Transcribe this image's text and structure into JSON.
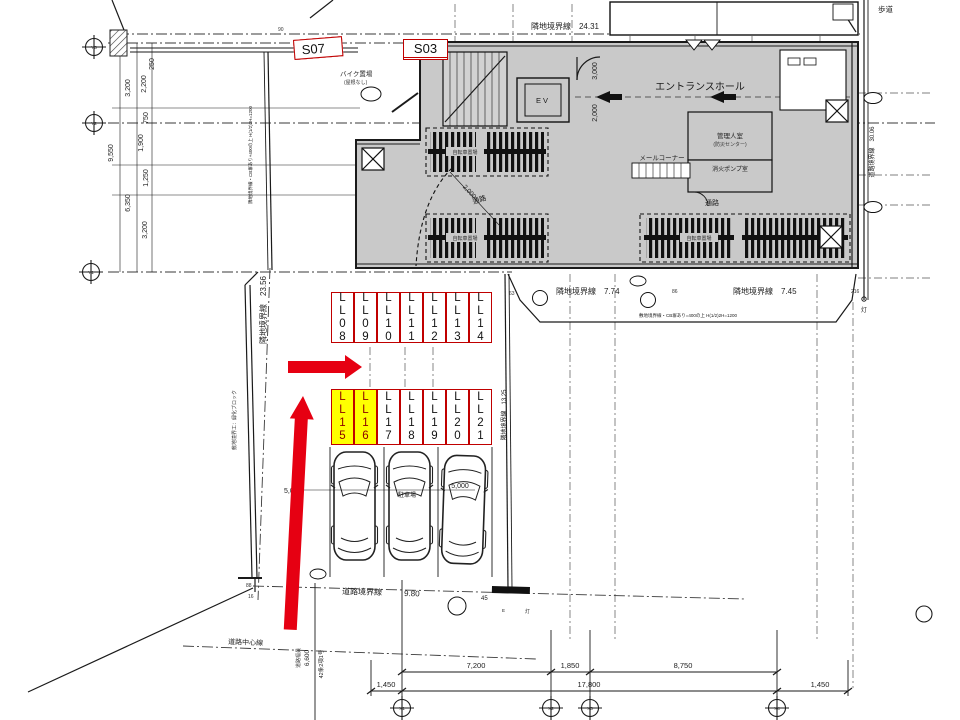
{
  "annotations": {
    "left_labels": [
      "LL04",
      "LL05",
      "LL06",
      "S07"
    ],
    "stair_labels": [
      "S01",
      "S02",
      "S03"
    ],
    "row1_labels": [
      "LL08",
      "LL09",
      "LL10",
      "LL11",
      "LL12",
      "LL13",
      "LL14"
    ],
    "row2_labels": [
      "LL15",
      "LL16",
      "LL17",
      "LL18",
      "LL19",
      "LL20",
      "LL21"
    ],
    "highlighted_labels": [
      "LL15",
      "LL16"
    ],
    "highlight_color": "#ffff00",
    "highlight_text_color": "#8b0000",
    "box_border_color": "#c00000",
    "arrow_color": "#e60012"
  },
  "plan": {
    "boundaries": {
      "top": "隣地境界線　24.31",
      "left": "隣地境界線　23.56",
      "left_note": "隣地境界線・CB塀あり+400の上 H(1/2)3H=1200",
      "left_fence": "敷地境界工：緑化ブロック",
      "bottom_mid1": "隣地境界線　7.74",
      "bottom_mid2": "隣地境界線　7.45",
      "bottom_note": "敷地境界線・CB塀あり=400の上 H(1/2)2H=1200",
      "inner_right": "隣地境界線　13.25",
      "road": "道路境界線",
      "road_val": "9.80",
      "road_right": "道路境界線　30.06",
      "road_center": "道路中心線",
      "road_width_label": "道路幅員",
      "road_width_val": "6,600",
      "road_class": "42条2項1号",
      "sidewalk": "歩道"
    },
    "rooms": {
      "entrance": "エントランスホール",
      "ev": "EV",
      "mail": "メールコーナー",
      "manager": "管理人室",
      "manager2": "(防災センター)",
      "pump": "消火ポンプ室",
      "corridor": "通路",
      "bike_racks": "自転車置場",
      "moto": "バイク置場",
      "moto2": "(屋根なし)",
      "parking": "駐車場"
    },
    "dims": {
      "left": [
        "250",
        "3,200",
        "2,200",
        "750",
        "1,900",
        "9,550",
        "1,250",
        "6,350",
        "3,200"
      ],
      "bottom_upper": [
        "7,200",
        "1,850",
        "8,750"
      ],
      "bottom_lower": [
        "1,450",
        "17,800",
        "1,450"
      ],
      "v3000": "3,000",
      "v2000": "2,000",
      "diag2000": "2,000",
      "p5000": "5,000",
      "misc": {
        "d90": "90",
        "d45": "45",
        "d86": "86",
        "d63": "63",
        "d88": "88",
        "d16": "16",
        "d216": "216",
        "lamp": "灯",
        "e": "E"
      }
    },
    "grid": {
      "y": [
        "Y3",
        "Y2",
        "Y1"
      ],
      "x": [
        "X1",
        "X2",
        "X3",
        "X4"
      ]
    }
  }
}
